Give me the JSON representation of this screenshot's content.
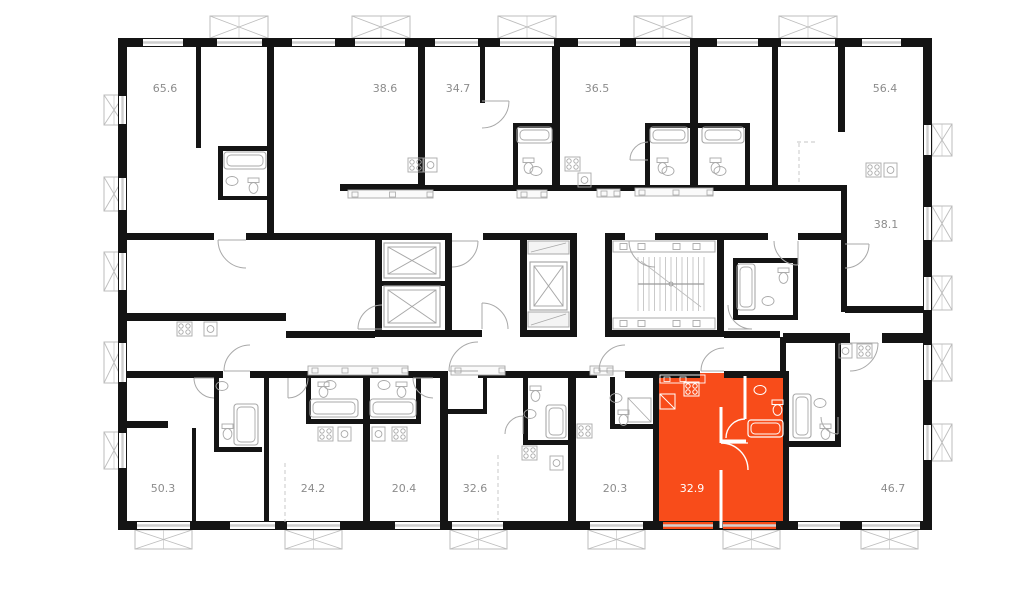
{
  "floorplan": {
    "title": "floor-plan",
    "selected_unit": {
      "area": "32.9"
    },
    "units": [
      {
        "id": "65-6",
        "area": "65.6",
        "selected": false
      },
      {
        "id": "38-6",
        "area": "38.6",
        "selected": false
      },
      {
        "id": "34-7",
        "area": "34.7",
        "selected": false
      },
      {
        "id": "36-5",
        "area": "36.5",
        "selected": false
      },
      {
        "id": "56-4",
        "area": "56.4",
        "selected": false
      },
      {
        "id": "38-1",
        "area": "38.1",
        "selected": false
      },
      {
        "id": "50-3",
        "area": "50.3",
        "selected": false
      },
      {
        "id": "24-2",
        "area": "24.2",
        "selected": false
      },
      {
        "id": "20-4",
        "area": "20.4",
        "selected": false
      },
      {
        "id": "32-6",
        "area": "32.6",
        "selected": false
      },
      {
        "id": "20-3",
        "area": "20.3",
        "selected": false
      },
      {
        "id": "32-9",
        "area": "32.9",
        "selected": true
      },
      {
        "id": "46-7",
        "area": "46.7",
        "selected": false
      }
    ],
    "colors": {
      "selected_fill": "#F84C1A",
      "wall": "#141414",
      "fixture": "#a8a8a8",
      "glazing": "#cfcfcf",
      "balcony": "#bdbdbd",
      "label": "#8c8c8c",
      "selected_label": "#ffffff",
      "background": "#ffffff"
    }
  }
}
